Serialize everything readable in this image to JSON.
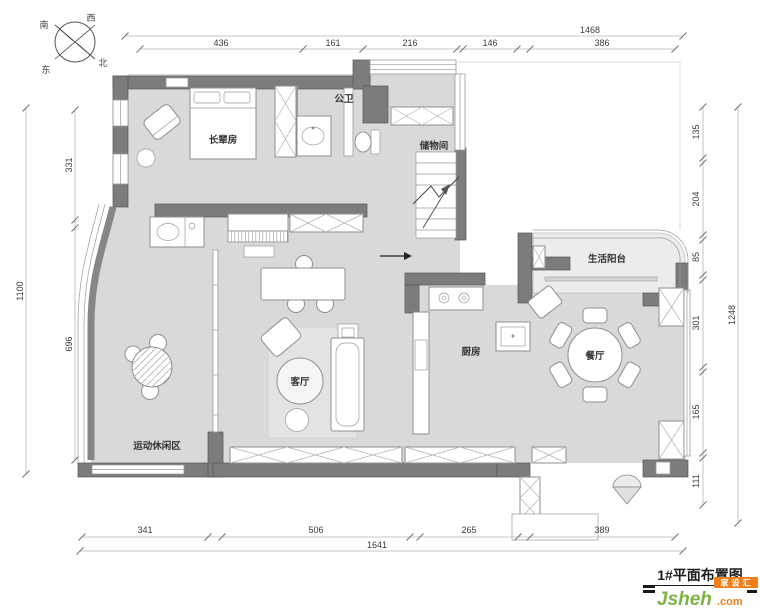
{
  "compass": {
    "south": "南",
    "west": "西",
    "east": "东",
    "north": "北"
  },
  "dimensions": {
    "top_total": "1468",
    "top": [
      "436",
      "161",
      "216",
      "146",
      "386"
    ],
    "left_total": "1100",
    "left": [
      "331",
      "696"
    ],
    "right_total": "1248",
    "right": [
      "135",
      "204",
      "85",
      "301",
      "165",
      "111"
    ],
    "bottom_total": "1641",
    "bottom": [
      "341",
      "506",
      "265",
      "389"
    ]
  },
  "rooms": {
    "elder_bedroom": "长辈房",
    "public_bath": "公卫",
    "storage": "储物间",
    "life_balcony": "生活阳台",
    "kitchen": "厨房",
    "dining": "餐厅",
    "living": "客厅",
    "leisure": "运动休闲区"
  },
  "title_block": {
    "plan_title": "1#平面布置图"
  },
  "logo": {
    "wordmark": "Jsheh",
    "tld": ".com",
    "badge": "家设汇"
  },
  "colors": {
    "wall": "#7c7c7c",
    "floor": "#d9d9d9",
    "logo_green": "#7cb342",
    "logo_orange": "#ef7f1a"
  }
}
